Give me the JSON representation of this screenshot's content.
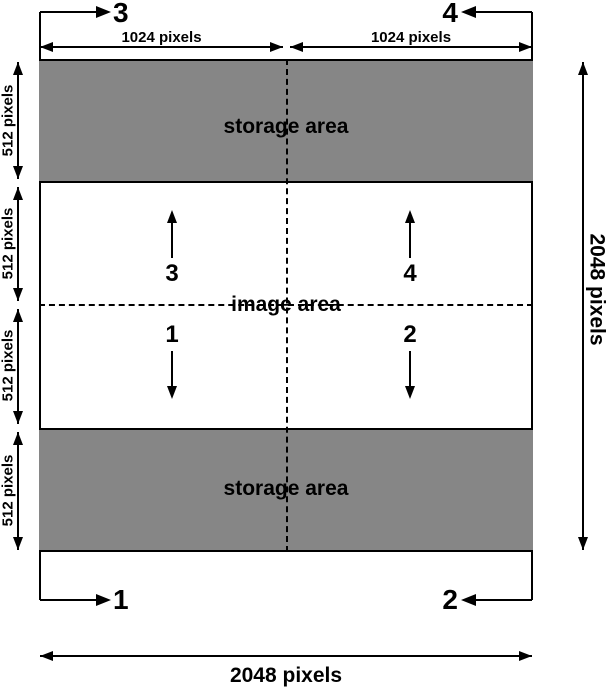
{
  "colors": {
    "storage_fill": "#868686",
    "line": "#000000",
    "background": "#ffffff"
  },
  "areas": {
    "storage_top": "storage area",
    "image": "image area",
    "storage_bottom": "storage area"
  },
  "dims": {
    "top_left": "1024 pixels",
    "top_right": "1024 pixels",
    "left": [
      "512 pixels",
      "512 pixels",
      "512 pixels",
      "512 pixels"
    ],
    "right": "2048 pixels",
    "bottom": "2048 pixels"
  },
  "readout": {
    "top_left": "3",
    "top_right": "4",
    "bottom_left": "1",
    "bottom_right": "2"
  },
  "transfer": {
    "up_left": "3",
    "up_right": "4",
    "down_left": "1",
    "down_right": "2"
  }
}
